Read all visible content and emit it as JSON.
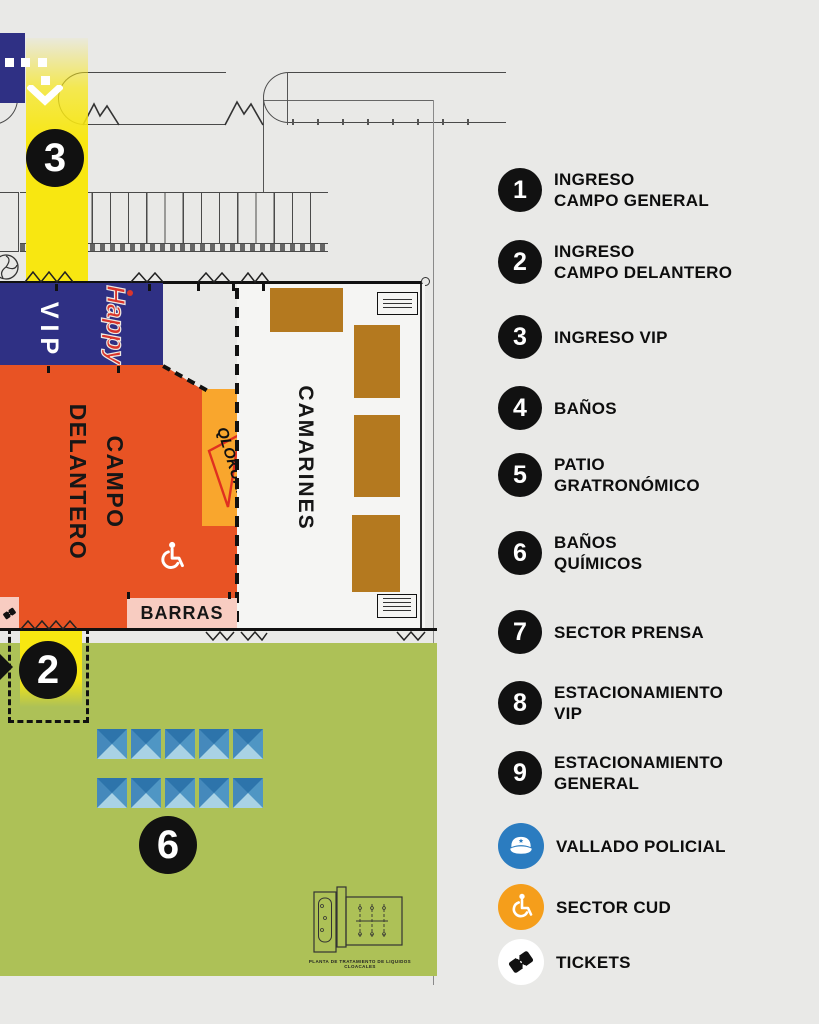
{
  "colors": {
    "background": "#e9e9e7",
    "navy": "#2f3084",
    "highlight_yellow": "#f8e711",
    "campo_orange": "#e85324",
    "escenario_orange": "#f9a62d",
    "camarines_brown": "#b4791f",
    "barras_pink": "#f8ccc1",
    "grass_green": "#adc157",
    "police_blue": "#2b7cc0",
    "cud_orange": "#f59e1b",
    "marker_black": "#111111"
  },
  "map": {
    "labels": {
      "vip": "VIP",
      "campo_line1": "CAMPO",
      "campo_line2": "DELANTERO",
      "escenario": "ESCENARIO",
      "camarines": "CAMARINES",
      "barras": "BARRAS",
      "happy_logo": "Happy",
      "qlokura_logo": "QLOKURA"
    },
    "markers": {
      "ingreso_vip": "3",
      "ingreso_campo_delantero": "2",
      "banos_quimicos": "6"
    },
    "plant_caption": "PLANTA DE TRATAMIENTO DE LIQUIDOS CLOACALES"
  },
  "legend": {
    "items": [
      {
        "num": "1",
        "lines": [
          "INGRESO",
          "CAMPO GENERAL"
        ]
      },
      {
        "num": "2",
        "lines": [
          "INGRESO",
          "CAMPO DELANTERO"
        ]
      },
      {
        "num": "3",
        "lines": [
          "INGRESO VIP"
        ]
      },
      {
        "num": "4",
        "lines": [
          "BAÑOS"
        ]
      },
      {
        "num": "5",
        "lines": [
          "PATIO",
          "GRATRONÓMICO"
        ]
      },
      {
        "num": "6",
        "lines": [
          "BAÑOS",
          "QUÍMICOS"
        ]
      },
      {
        "num": "7",
        "lines": [
          "SECTOR PRENSA"
        ]
      },
      {
        "num": "8",
        "lines": [
          "ESTACIONAMIENTO",
          "VIP"
        ]
      },
      {
        "num": "9",
        "lines": [
          "ESTACIONAMIENTO",
          "GENERAL"
        ]
      }
    ],
    "icon_items": [
      {
        "icon": "police-cap-icon",
        "label": "VALLADO POLICIAL"
      },
      {
        "icon": "wheelchair-icon",
        "label": "SECTOR CUD"
      },
      {
        "icon": "ticket-icon",
        "label": "TICKETS"
      }
    ]
  }
}
